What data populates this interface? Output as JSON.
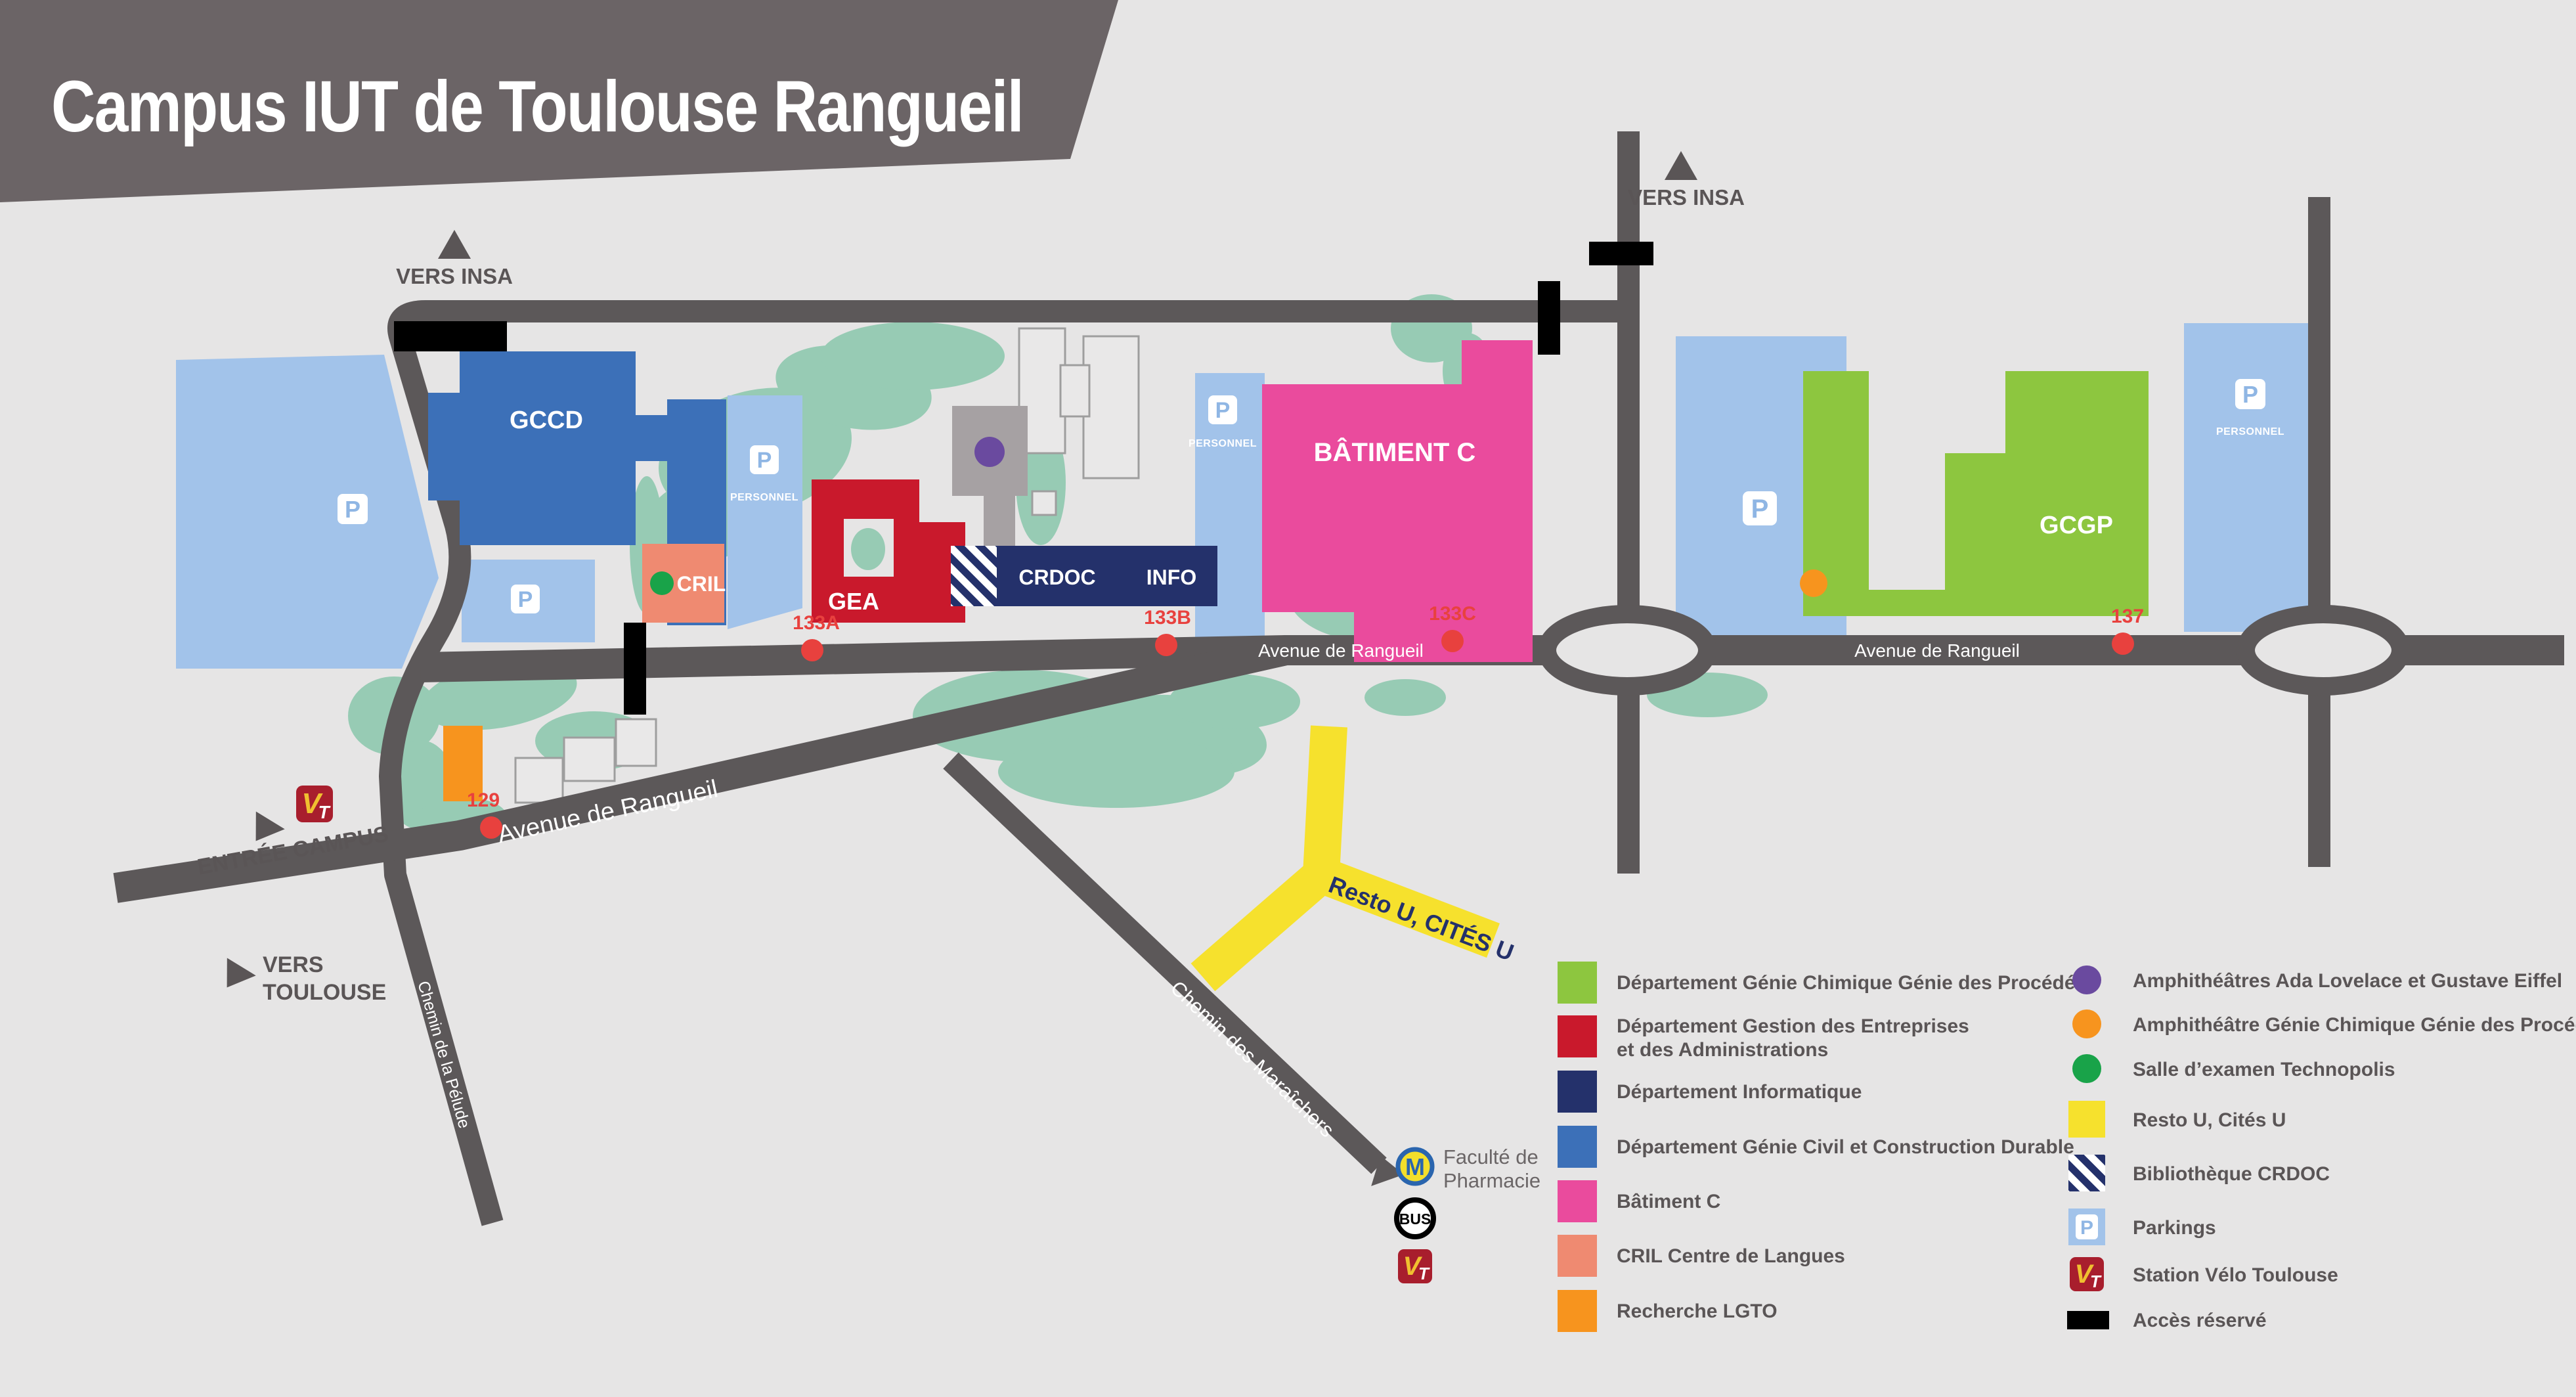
{
  "title": "Campus IUT de Toulouse Rangueil",
  "colors": {
    "background": "#e6e5e5",
    "banner": "#6b6466",
    "road": "#5c5859",
    "green_area": "#97cbb4",
    "parking_blue": "#a2c3ea",
    "gccd_blue": "#3c70b8",
    "info_navy": "#24316b",
    "gea_red": "#c9192c",
    "cril_salmon": "#ef8a71",
    "batiment_c_pink": "#ea4b9d",
    "gcgp_green": "#8dc63f",
    "lgto_orange": "#f7941e",
    "resto_yellow": "#f6e12d",
    "amphi_purple": "#6a4a9f",
    "technopolis_green": "#19a349",
    "stop_red": "#e8413e",
    "velo_red": "#a81e2d",
    "metro_yellow": "#f3df2b",
    "metro_blue": "#2a65ae",
    "acces_black": "#000000"
  },
  "map": {
    "buildings": {
      "gccd": "GCCD",
      "gea": "GEA",
      "cril": "CRIL",
      "crdoc": "CRDOC",
      "info": "INFO",
      "batiment_c": "BÂTIMENT C",
      "gcgp": "GCGP"
    },
    "roads": {
      "avenue_diagonal": "Avenue de Rangueil",
      "avenue_center": "Avenue de Rangueil",
      "avenue_right": "Avenue de Rangueil",
      "chemin_maraichers": "Chemin des Maraîchers",
      "chemin_pelude": "Chemin de la Pélude",
      "resto_u": "Resto U, CITÉS U"
    },
    "directions": {
      "vers_insa_left": "VERS INSA",
      "vers_insa_right": "VERS INSA",
      "entree_campus": "ENTRÉE CAMPUS",
      "vers_toulouse_line1": "VERS",
      "vers_toulouse_line2": "TOULOUSE"
    },
    "stops": [
      {
        "label": "133A"
      },
      {
        "label": "133B"
      },
      {
        "label": "133C"
      },
      {
        "label": "137"
      },
      {
        "label": "129"
      }
    ],
    "parking_label": "P",
    "personnel_label": "PERSONNEL",
    "poi": {
      "faculte_line1": "Faculté de",
      "faculte_line2": "Pharmacie",
      "bus": "BUS",
      "metro": "M",
      "velo_v": "V",
      "velo_t": "T"
    }
  },
  "legend": {
    "left": [
      {
        "color": "#8dc63f",
        "label": "Département Génie Chimique Génie des Procédés"
      },
      {
        "color": "#c9192c",
        "label": "Département Gestion des Entreprises",
        "label2": "et des Administrations"
      },
      {
        "color": "#24316b",
        "label": "Département Informatique"
      },
      {
        "color": "#3c70b8",
        "label": "Département Génie Civil et Construction Durable"
      },
      {
        "color": "#ea4b9d",
        "label": "Bâtiment C"
      },
      {
        "color": "#ef8a71",
        "label": "CRIL Centre de Langues"
      },
      {
        "color": "#f7941e",
        "label": "Recherche LGTO"
      }
    ],
    "right": [
      {
        "type": "circle",
        "color": "#6a4a9f",
        "label": "Amphithéâtres Ada Lovelace et Gustave Eiffel"
      },
      {
        "type": "circle",
        "color": "#f7941e",
        "label": "Amphithéâtre Génie Chimique Génie des Procédés"
      },
      {
        "type": "circle",
        "color": "#19a349",
        "label": "Salle d’examen Technopolis"
      },
      {
        "type": "square",
        "color": "#f6e12d",
        "label": "Resto U, Cités U"
      },
      {
        "type": "stripes",
        "color": "#24316b",
        "label": "Bibliothèque CRDOC"
      },
      {
        "type": "parking",
        "color": "#a2c3ea",
        "label": "Parkings"
      },
      {
        "type": "velo",
        "color": "#a81e2d",
        "label": "Station Vélo Toulouse"
      },
      {
        "type": "bar",
        "color": "#000000",
        "label": "Accès réservé"
      }
    ]
  }
}
